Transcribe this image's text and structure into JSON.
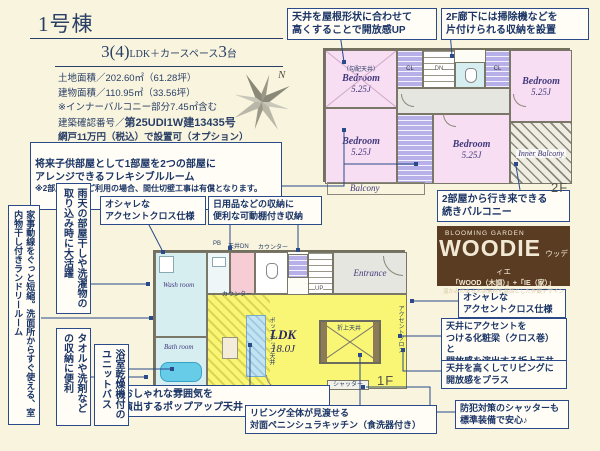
{
  "colors": {
    "background": "#f8f4de",
    "navy": "#1e3a6e",
    "bedroom_pink": "#f7def2",
    "ldk_yellow": "#faf675",
    "closet_purple": "#b7b0e8",
    "water_blue": "#d7eef1",
    "woodie_brown": "#5a3c22"
  },
  "header": {
    "building": "1号棟",
    "plan_big1": "3(4)",
    "plan_mid": "LDK＋カースペース",
    "plan_big2": "3",
    "plan_tail": "台",
    "land_area": "土地面積／202.60㎡（61.28坪）",
    "building_area": "建物面積／110.95㎡（33.56坪）",
    "balcony_note": "※インナーバルコニー部分7.45㎡含む",
    "approval_label": "建築確認番号／",
    "approval_number": "第25UDI1W建13435号",
    "screen_note": "網戸11万円（税込）で設置可（オプション）"
  },
  "compass": {
    "north": "N"
  },
  "callouts": {
    "flexible_room": "将来子供部屋として1部屋を2つの部屋に\nアレンジできるフレキシブルルーム",
    "flexible_note": "※2部屋としてご利用の場合、間仕切壁工事は有償となります。",
    "sloped_ceiling": "天井を屋根形状に合わせて\n高くすることで開放感UP",
    "hall_storage": "2F廊下には掃除機などを\n片付けられる収納を設置",
    "tsuzuki_balcony": "2部屋から行き来できる\n続きバルコニー",
    "accent_cross_wash": "オシャレな\nアクセントクロス仕様",
    "movable_shelf": "日用品などの収納に\n便利な可動棚付き収納",
    "laundry_room": "家事動線をぐっと短縮。洗面所からすぐ使える、室内物干し付きランドリールーム",
    "rainy_day": "雨天の部屋干しや洗濯物の取り込み時に大活躍",
    "towel_storage": "タオルや洗剤などの収納に便利",
    "unit_bath": "浴室乾燥機付のユニットバス",
    "popup_ceiling": "おしゃれな雰囲気を\n演出するポップアップ天井",
    "peninsula_kitchen": "リビング全体が見渡せる\n対面ペニンシュラキッチン（食洗器付き）",
    "accent_cross_ldk": "オシャレな\nアクセントクロス仕様",
    "decorative_beam": "天井にアクセントを\nつける化粧梁（クロス巻）と\n開放感を演出する折上天井",
    "high_ceiling": "天井を高くしてリビングに\n開放感をプラス",
    "shutter": "防犯対策のシャッターも\n標準装備で安心♪"
  },
  "brand": {
    "series": "BLOOMING GARDEN",
    "name": "WOODIE",
    "kana": "ウッディエ",
    "formula": "「WOOD（木調）」+「IE（家）」",
    "tagline": "温かみのある木調素材を基調とした外観デザイン"
  },
  "plan2f": {
    "floor_label": "2F",
    "bedroom": "Bedroom",
    "bedroom_size": "5.25J",
    "sloped_note": "（勾配天井）",
    "closet": "CL",
    "dn": "DN",
    "inner_balcony": "Inner Balcony",
    "balcony": "Balcony"
  },
  "plan1f": {
    "floor_label": "1F",
    "ldk": "LDK",
    "ldk_size": "18.0J",
    "entrance": "Entrance",
    "wash_room": "Wash room",
    "bath_room": "Bath room",
    "up": "UP",
    "hallway": "廊下",
    "oriage": "折上天井",
    "accent_cross": "アクセントクロス",
    "popup": "ポップアップ天井",
    "counter": "カウンター",
    "pb": "PB",
    "ceiling_dn": "天井DN",
    "kitchen_door": "勝手口",
    "shutter": "シャッター"
  }
}
